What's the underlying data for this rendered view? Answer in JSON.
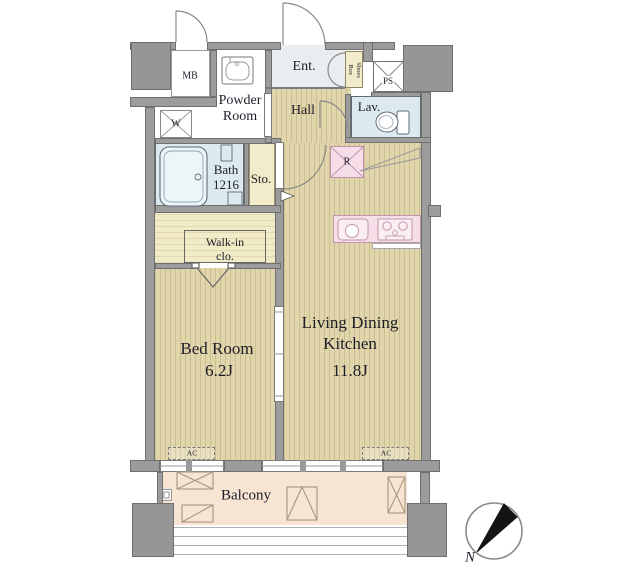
{
  "plan": {
    "type": "apartment-floor-plan",
    "rooms": {
      "mb": {
        "label": "MB"
      },
      "powder_room": {
        "label_line1": "Powder",
        "label_line2": "Room"
      },
      "entrance": {
        "label": "Ent."
      },
      "shoes_box": {
        "label_line1": "Shoes",
        "label_line2": "Box"
      },
      "ps": {
        "label": "PS"
      },
      "hall": {
        "label": "Hall"
      },
      "lavatory": {
        "label": "Lav."
      },
      "washer": {
        "label": "W"
      },
      "bath": {
        "label_line1": "Bath",
        "label_line2": "1216"
      },
      "storage": {
        "label": "Sto."
      },
      "refrigerator": {
        "label": "R"
      },
      "walk_in_closet": {
        "label_line1": "Walk-in",
        "label_line2": "clo."
      },
      "bedroom": {
        "label": "Bed Room",
        "size": "6.2J"
      },
      "living_dining_kitchen": {
        "label_line1": "Living Dining",
        "label_line2": "Kitchen",
        "size": "11.8J"
      },
      "balcony": {
        "label": "Balcony"
      },
      "air_conditioner": {
        "label": "AC"
      }
    },
    "compass": {
      "north_label": "N"
    },
    "colors": {
      "wall_gray": "#9c9c9c",
      "wood_floor": "#e1d6ab",
      "closet_yellow": "#f2ecca",
      "wet_area_blue": "#dce9ef",
      "kitchen_pink": "#f6dee8",
      "balcony_peach": "#f8e4d3",
      "entry_gray": "#eaedef",
      "text": "#1d1d28"
    }
  }
}
